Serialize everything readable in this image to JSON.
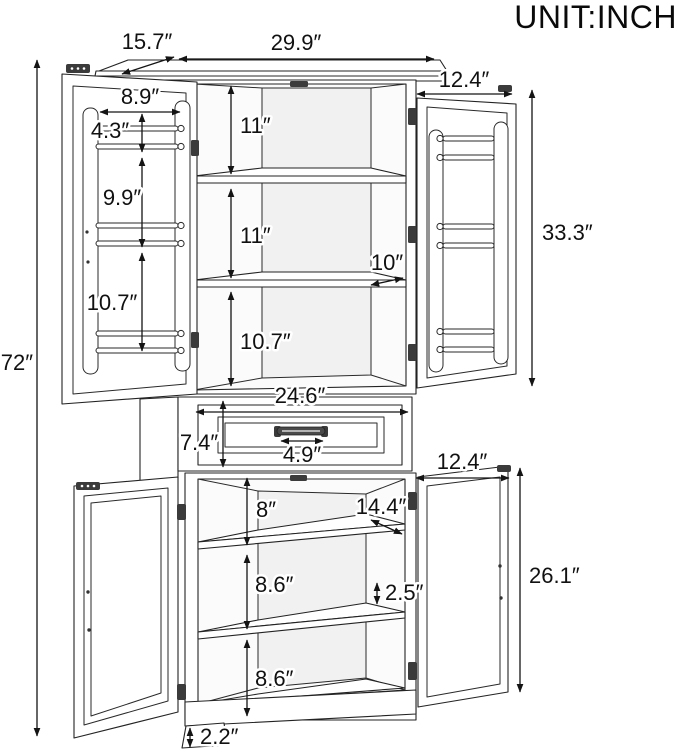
{
  "title": "UNIT:INCH",
  "dimensions": {
    "overall": {
      "height": "72″"
    },
    "top_board": {
      "depth": "15.7″",
      "width": "29.9″"
    },
    "upper_cabinet": {
      "height": "33.3″",
      "left_door": {
        "width": "8.9″",
        "rack1_height": "4.3″",
        "rack2_height": "9.9″",
        "rack3_height": "10.7″"
      },
      "right_door": {
        "width": "12.4″"
      },
      "interior": {
        "compartment1_height": "11″",
        "compartment2_height": "11″",
        "compartment3_height": "10.7″",
        "shelf_depth": "10″"
      }
    },
    "drawer": {
      "width": "24.6″",
      "height": "7.4″",
      "handle_width": "4.9″"
    },
    "lower_cabinet": {
      "height": "26.1″",
      "right_door": {
        "width": "12.4″"
      },
      "interior": {
        "compartment1_height": "8″",
        "compartment2_height": "8.6″",
        "compartment3_height": "8.6″",
        "shelf_depth": "14.4″",
        "shelf_clearance": "2.5″"
      },
      "base_height": "2.2″"
    }
  },
  "colors": {
    "line": "#232323",
    "background": "#ffffff",
    "text": "#111111"
  }
}
